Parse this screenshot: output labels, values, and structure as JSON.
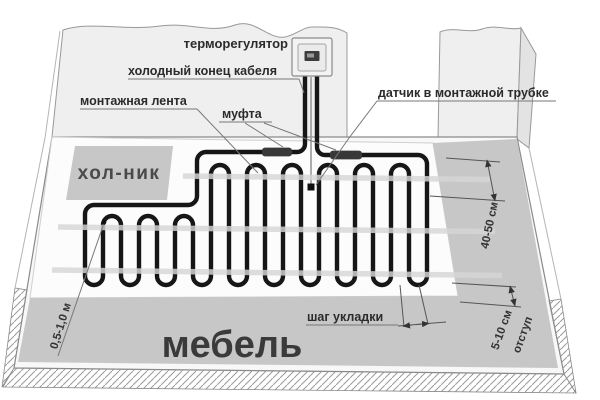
{
  "diagram": {
    "title_semantic": "floor-heating-cable-installation-scheme",
    "labels": {
      "thermostat": "терморегулятор",
      "cold_end": "холодный конец кабеля",
      "mounting_tape": "монтажная лента",
      "coupling": "муфта",
      "sensor": "датчик в монтажной трубке",
      "fridge": "хол-ник",
      "furniture": "мебель",
      "laying_step": "шаг укладки"
    },
    "dimensions": {
      "row_zone_depth": "40-50 см",
      "edge_offset_value": "5-10 см",
      "edge_offset_word": "отступ",
      "left_distance": "0,5-1,0 м"
    },
    "colors": {
      "cable": "#161616",
      "floor_gray": "#c7c7c7",
      "wall": "#efefef",
      "tape_band": "#d6d6d6",
      "leader_line": "#777777",
      "text": "#2b2b2b"
    }
  }
}
